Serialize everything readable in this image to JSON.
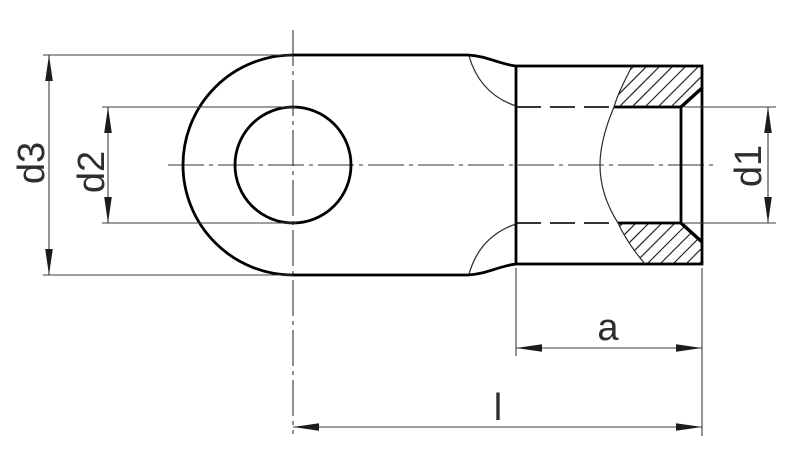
{
  "page": {
    "background": "#ffffff"
  },
  "drawing": {
    "description": "Cross-section technical drawing of a ring cable lug (eyelet terminal) with a partially sectioned crimp barrel",
    "colors": {
      "contour": "#000000",
      "thin_line": "#3c3c3c",
      "hatch": "#222222",
      "text": "#2e2e2e",
      "background": "#ffffff"
    },
    "labels": {
      "d1": "d1",
      "d2": "d2",
      "d3": "d3",
      "a": "a",
      "l": "l"
    }
  }
}
